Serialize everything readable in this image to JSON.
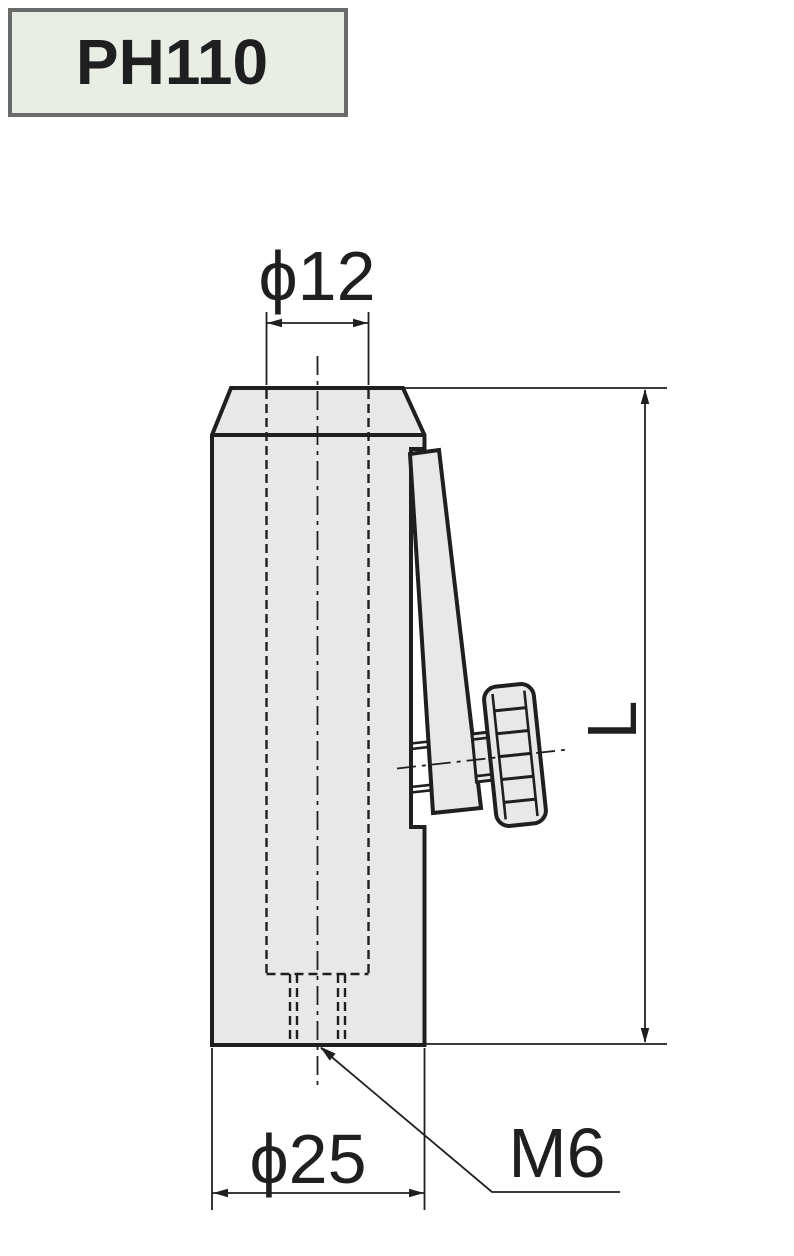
{
  "title_box": {
    "label": "PH110"
  },
  "dimensions": {
    "top_diameter": "ϕ12",
    "bottom_diameter": "ϕ25",
    "thread": "M6",
    "length": "L"
  },
  "colors": {
    "line": "#1f1f1f",
    "part_fill": "#e8e8e8",
    "title_box_fill": "#e9eee5",
    "title_box_border": "#6a6a6a",
    "background": "#ffffff"
  }
}
